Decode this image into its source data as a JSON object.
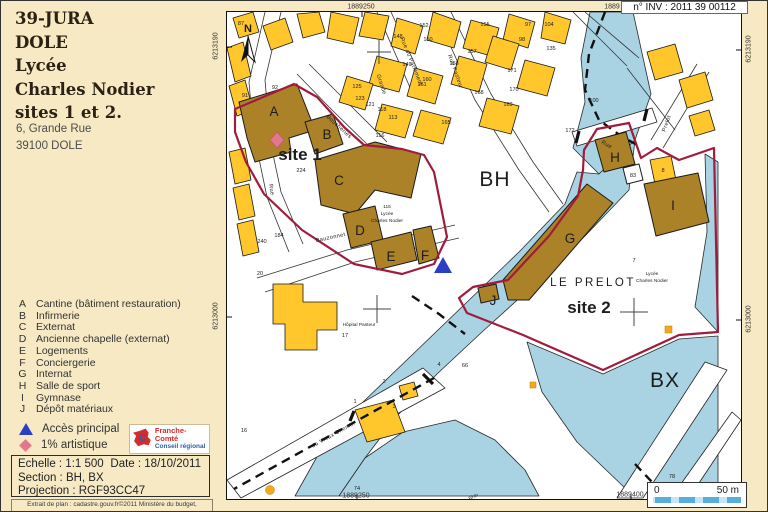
{
  "colors": {
    "cream": "#F6E9C3",
    "water": "#A9D2E3",
    "parcelyellow": "#FFC72C",
    "lyceebrown": "#AC8229",
    "boundary": "#A01C3C",
    "accessblue": "#2B3FC4",
    "artpink": "#E2788C",
    "logored": "#D42B2B",
    "logoblue": "#2B5EA7",
    "dotorange": "#F5A81C",
    "sblight": "#C7E4F2",
    "sbdark": "#56AEDC"
  },
  "header": {
    "inventory_label": "n° INV : 2011 39 00112"
  },
  "title_block": {
    "lines": [
      "39-JURA",
      "DOLE",
      "Lycée",
      "Charles Nodier",
      "sites 1 et 2."
    ],
    "address_lines": [
      "6, Grande Rue",
      "39100 DOLE"
    ]
  },
  "legend": {
    "items": [
      {
        "letter": "A",
        "label": "Cantine (bâtiment restauration)"
      },
      {
        "letter": "B",
        "label": "Infirmerie"
      },
      {
        "letter": "C",
        "label": "Externat"
      },
      {
        "letter": "D",
        "label": "Ancienne chapelle (externat)"
      },
      {
        "letter": "E",
        "label": "Logements"
      },
      {
        "letter": "F",
        "label": "Conciergerie"
      },
      {
        "letter": "G",
        "label": "Internat"
      },
      {
        "letter": "H",
        "label": "Salle de sport"
      },
      {
        "letter": "I",
        "label": "Gymnase"
      },
      {
        "letter": "J",
        "label": "Dépôt matériaux"
      }
    ],
    "symbols": [
      {
        "shape": "triangle",
        "color": "#2B3FC4",
        "label": "Accès principal"
      },
      {
        "shape": "diamond",
        "color": "#E2788C",
        "label": "1% artistique"
      }
    ]
  },
  "logo": {
    "line1": "Franche-Comté",
    "line2": "Conseil régional"
  },
  "info_box": {
    "scale": "Echelle : 1:1 500",
    "date": "Date : 18/10/2011",
    "section": "Section : BH, BX",
    "projection": "Projection : RGF93CC47"
  },
  "footnote": "Extrait de plan : cadastre.gouv.fr©2011 Ministère du budget,",
  "scale_bar": {
    "left": "0",
    "right": "50 m"
  },
  "map": {
    "coordinates": [
      {
        "text": "1889250",
        "x": 360,
        "y": 6,
        "rot": 0
      },
      {
        "text": "1889",
        "x": 611,
        "y": 6,
        "rot": 0
      },
      {
        "text": "6213190",
        "x": 215,
        "y": 45,
        "rot": -90
      },
      {
        "text": "6213000",
        "x": 215,
        "y": 315,
        "rot": -90
      },
      {
        "text": "6213190",
        "x": 748,
        "y": 48,
        "rot": -90
      },
      {
        "text": "6213000",
        "x": 748,
        "y": 318,
        "rot": -90
      },
      {
        "text": "1889250",
        "x": 355,
        "y": 495,
        "rot": 0
      },
      {
        "text": "1889400",
        "x": 629,
        "y": 494,
        "rot": 0
      }
    ],
    "labels": [
      {
        "kind": "zone",
        "text": "BH",
        "x": 268,
        "y": 174
      },
      {
        "kind": "zone",
        "text": "BX",
        "x": 438,
        "y": 375
      },
      {
        "kind": "site",
        "text": "site 1",
        "x": 73,
        "y": 148
      },
      {
        "kind": "site",
        "text": "site 2",
        "x": 362,
        "y": 301
      },
      {
        "kind": "prelot",
        "text": "LE PRELOT",
        "x": 366,
        "y": 274
      },
      {
        "kind": "bldg",
        "text": "A",
        "x": 47,
        "y": 104
      },
      {
        "kind": "bldg",
        "text": "B",
        "x": 100,
        "y": 127
      },
      {
        "kind": "bldg",
        "text": "C",
        "x": 112,
        "y": 173
      },
      {
        "kind": "bldg",
        "text": "D",
        "x": 133,
        "y": 223
      },
      {
        "kind": "bldg",
        "text": "E",
        "x": 164,
        "y": 249
      },
      {
        "kind": "bldg",
        "text": "F",
        "x": 198,
        "y": 248
      },
      {
        "kind": "bldg",
        "text": "G",
        "x": 343,
        "y": 231
      },
      {
        "kind": "bldg",
        "text": "H",
        "x": 388,
        "y": 150
      },
      {
        "kind": "bldg",
        "text": "I",
        "x": 446,
        "y": 198
      },
      {
        "kind": "bldg",
        "text": "J",
        "x": 266,
        "y": 293
      },
      {
        "kind": "north",
        "text": "N",
        "x": 21,
        "y": 20
      },
      {
        "kind": "small",
        "text": "115",
        "x": 160,
        "y": 196
      },
      {
        "kind": "small",
        "text": "Lycée",
        "x": 160,
        "y": 203
      },
      {
        "kind": "small",
        "text": "Charles Nodier",
        "x": 160,
        "y": 210
      },
      {
        "kind": "small",
        "text": "Lycée",
        "x": 425,
        "y": 263
      },
      {
        "kind": "small",
        "text": "Charles Nodier",
        "x": 425,
        "y": 270
      },
      {
        "kind": "small",
        "text": "Hôpital Pasteur",
        "x": 132,
        "y": 314
      },
      {
        "kind": "small",
        "text": "Rhin",
        "x": 247,
        "y": 486,
        "rot": -25
      },
      {
        "kind": "parcel",
        "text": "87",
        "x": 14,
        "y": 13
      },
      {
        "kind": "parcel",
        "text": "91",
        "x": 18,
        "y": 85
      },
      {
        "kind": "parcel",
        "text": "92",
        "x": 48,
        "y": 77
      },
      {
        "kind": "parcel",
        "text": "224",
        "x": 74,
        "y": 160
      },
      {
        "kind": "parcel",
        "text": "125",
        "x": 130,
        "y": 76
      },
      {
        "kind": "parcel",
        "text": "123",
        "x": 133,
        "y": 88
      },
      {
        "kind": "parcel",
        "text": "121",
        "x": 143,
        "y": 94
      },
      {
        "kind": "parcel",
        "text": "118",
        "x": 155,
        "y": 99
      },
      {
        "kind": "parcel",
        "text": "113",
        "x": 166,
        "y": 107
      },
      {
        "kind": "parcel",
        "text": "116",
        "x": 153,
        "y": 125
      },
      {
        "kind": "parcel",
        "text": "152",
        "x": 197,
        "y": 15
      },
      {
        "kind": "parcel",
        "text": "148",
        "x": 171,
        "y": 26
      },
      {
        "kind": "parcel",
        "text": "150",
        "x": 201,
        "y": 29
      },
      {
        "kind": "parcel",
        "text": "155",
        "x": 258,
        "y": 14
      },
      {
        "kind": "parcel",
        "text": "157",
        "x": 245,
        "y": 41
      },
      {
        "kind": "parcel",
        "text": "158",
        "x": 227,
        "y": 53
      },
      {
        "kind": "parcel",
        "text": "149",
        "x": 180,
        "y": 54
      },
      {
        "kind": "parcel",
        "text": "160",
        "x": 200,
        "y": 69
      },
      {
        "kind": "parcel",
        "text": "161",
        "x": 195,
        "y": 74
      },
      {
        "kind": "parcel",
        "text": "97",
        "x": 301,
        "y": 14
      },
      {
        "kind": "parcel",
        "text": "98",
        "x": 295,
        "y": 29
      },
      {
        "kind": "parcel",
        "text": "104",
        "x": 322,
        "y": 14
      },
      {
        "kind": "parcel",
        "text": "135",
        "x": 324,
        "y": 38
      },
      {
        "kind": "parcel",
        "text": "171",
        "x": 285,
        "y": 60
      },
      {
        "kind": "parcel",
        "text": "170",
        "x": 287,
        "y": 79
      },
      {
        "kind": "parcel",
        "text": "168",
        "x": 252,
        "y": 82
      },
      {
        "kind": "parcel",
        "text": "169",
        "x": 281,
        "y": 94
      },
      {
        "kind": "parcel",
        "text": "165",
        "x": 219,
        "y": 112
      },
      {
        "kind": "parcel",
        "text": "172",
        "x": 343,
        "y": 120
      },
      {
        "kind": "parcel",
        "text": "100",
        "x": 367,
        "y": 90
      },
      {
        "kind": "parcel",
        "text": "184",
        "x": 52,
        "y": 225
      },
      {
        "kind": "parcel",
        "text": "240",
        "x": 35,
        "y": 231
      },
      {
        "kind": "parcel",
        "text": "20",
        "x": 33,
        "y": 263
      },
      {
        "kind": "parcel",
        "text": "16",
        "x": 17,
        "y": 420
      },
      {
        "kind": "parcel",
        "text": "17",
        "x": 118,
        "y": 325
      },
      {
        "kind": "parcel",
        "text": "7",
        "x": 407,
        "y": 250
      },
      {
        "kind": "parcel",
        "text": "4",
        "x": 212,
        "y": 354
      },
      {
        "kind": "parcel",
        "text": "66",
        "x": 238,
        "y": 355
      },
      {
        "kind": "parcel",
        "text": "2",
        "x": 157,
        "y": 371
      },
      {
        "kind": "parcel",
        "text": "1",
        "x": 128,
        "y": 391
      },
      {
        "kind": "parcel",
        "text": "3",
        "x": 167,
        "y": 396
      },
      {
        "kind": "parcel",
        "text": "74",
        "x": 130,
        "y": 478
      },
      {
        "kind": "parcel",
        "text": "78",
        "x": 445,
        "y": 466
      },
      {
        "kind": "parcel",
        "text": "83",
        "x": 406,
        "y": 165
      },
      {
        "kind": "parcel",
        "text": "8",
        "x": 436,
        "y": 160
      },
      {
        "kind": "street",
        "text": "Grande",
        "x": 153,
        "y": 73,
        "rot": 72
      },
      {
        "kind": "street",
        "text": "Rue du Parlement",
        "x": 183,
        "y": 50,
        "rot": 68
      },
      {
        "kind": "street",
        "text": "Rue Pasteur",
        "x": 227,
        "y": 60,
        "rot": 70
      },
      {
        "kind": "street",
        "text": "Boucheries",
        "x": 111,
        "y": 116,
        "rot": 42
      },
      {
        "kind": "street",
        "text": "Rue",
        "x": 43,
        "y": 178,
        "rot": 80
      },
      {
        "kind": "street",
        "text": "Bauzonnet",
        "x": 104,
        "y": 227,
        "rot": -12
      },
      {
        "kind": "street",
        "text": "Prelot",
        "x": 441,
        "y": 112,
        "rot": -70
      },
      {
        "kind": "street",
        "text": "Rue",
        "x": 379,
        "y": 134,
        "rot": 30
      },
      {
        "kind": "street",
        "text": "du Vieux Chemin",
        "x": 107,
        "y": 424,
        "rot": -29
      }
    ]
  }
}
